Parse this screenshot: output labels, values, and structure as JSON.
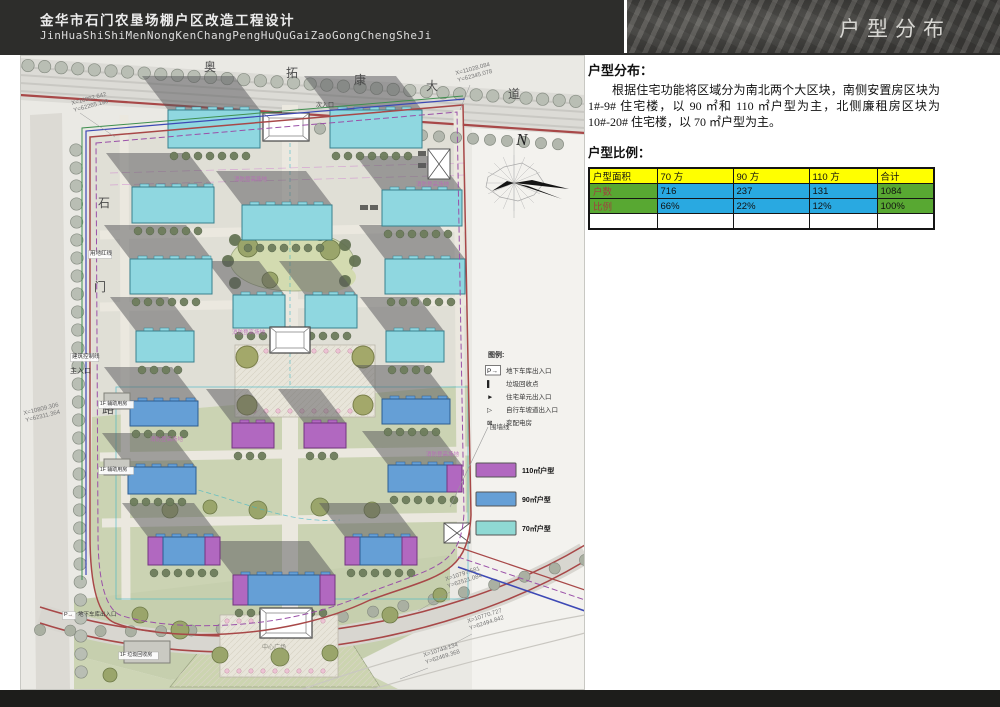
{
  "header": {
    "title_cn": "金华市石门农垦场棚户区改造工程设计",
    "title_en": "JinHuaShiShiMenNongKenChangPengHuQuGaiZaoGongChengSheJi",
    "section_title": "户型分布"
  },
  "panel": {
    "heading": "户型分布：",
    "paragraph": "根据住宅功能将区域分为南北两个大区块，南侧安置房区块为 1#-9# 住宅楼，以 90 ㎡和 110 ㎡户型为主，北侧廉租房区块为 10#-20# 住宅楼，以 70 ㎡户型为主。",
    "ratio_heading": "户型比例：",
    "table": {
      "columns": [
        "户型面积",
        "70 方",
        "90 方",
        "110 方",
        "合计"
      ],
      "col_widths": [
        68,
        76,
        76,
        68,
        57
      ],
      "rows": [
        {
          "label": "户数",
          "values": [
            "716",
            "237",
            "131",
            "1084"
          ]
        },
        {
          "label": "比例",
          "values": [
            "66%",
            "22%",
            "12%",
            "100%"
          ]
        }
      ],
      "colors": {
        "header_bg": "#ffff00",
        "label_bg": "#58a832",
        "label_text": "#a04040",
        "data_bg": "#29a9e1",
        "total_bg": "#58a832"
      }
    }
  },
  "map": {
    "north_label": "N",
    "colors": {
      "c": {
        "f": "#8fd7e0",
        "s": "#38808e"
      },
      "b": {
        "f": "#659fd6",
        "s": "#2c5d92"
      },
      "p": {
        "f": "#b168c0",
        "s": "#73357f"
      },
      "a": {
        "f": "#c9c9c2",
        "s": "#808078"
      },
      "shadow": "#55555a",
      "boundary_red": "#a84848",
      "boundary_purple": "#9a50a8",
      "boundary_blue": "#3d49b5",
      "boundary_green": "#3f8f4f"
    },
    "legend": {
      "title": "图例:",
      "items": [
        {
          "sym": "P→",
          "label": "地下车库出入口"
        },
        {
          "sym": "▌",
          "label": "垃圾回收点"
        },
        {
          "sym": "►",
          "label": "住宅单元出入口"
        },
        {
          "sym": "▷",
          "label": "自行车坡道出入口"
        },
        {
          "sym": "⊠",
          "label": "变配电房"
        }
      ]
    },
    "unit_types": [
      {
        "color": "#b168c0",
        "label": "110㎡户型"
      },
      {
        "color": "#659fd6",
        "label": "90㎡户型"
      },
      {
        "color": "#8fd9d4",
        "label": "70㎡户型"
      }
    ],
    "buildings": [
      {
        "x": 148,
        "y": 55,
        "w": 92,
        "h": 38,
        "t": "c"
      },
      {
        "x": 310,
        "y": 55,
        "w": 92,
        "h": 38,
        "t": "c"
      },
      {
        "x": 112,
        "y": 132,
        "w": 82,
        "h": 36,
        "t": "c"
      },
      {
        "x": 362,
        "y": 135,
        "w": 80,
        "h": 36,
        "t": "c"
      },
      {
        "x": 222,
        "y": 150,
        "w": 90,
        "h": 35,
        "t": "c"
      },
      {
        "x": 110,
        "y": 204,
        "w": 82,
        "h": 35,
        "t": "c"
      },
      {
        "x": 365,
        "y": 204,
        "w": 80,
        "h": 35,
        "t": "c"
      },
      {
        "x": 213,
        "y": 240,
        "w": 52,
        "h": 33,
        "t": "c",
        "n": "11"
      },
      {
        "x": 285,
        "y": 240,
        "w": 52,
        "h": 33,
        "t": "c",
        "n": "12"
      },
      {
        "x": 116,
        "y": 276,
        "w": 58,
        "h": 31,
        "t": "c",
        "n": "10"
      },
      {
        "x": 366,
        "y": 276,
        "w": 58,
        "h": 31,
        "t": "c",
        "n": "13"
      },
      {
        "x": 110,
        "y": 346,
        "w": 68,
        "h": 25,
        "t": "b"
      },
      {
        "x": 362,
        "y": 344,
        "w": 68,
        "h": 25,
        "t": "b"
      },
      {
        "x": 212,
        "y": 368,
        "w": 42,
        "h": 25,
        "t": "p"
      },
      {
        "x": 284,
        "y": 368,
        "w": 42,
        "h": 25,
        "t": "p"
      },
      {
        "x": 108,
        "y": 412,
        "w": 68,
        "h": 27,
        "t": "b"
      },
      {
        "x": 368,
        "y": 410,
        "w": 74,
        "h": 27,
        "t": "mbr"
      },
      {
        "x": 128,
        "y": 482,
        "w": 72,
        "h": 28,
        "t": "m"
      },
      {
        "x": 325,
        "y": 482,
        "w": 72,
        "h": 28,
        "t": "m"
      },
      {
        "x": 213,
        "y": 520,
        "w": 102,
        "h": 30,
        "t": "m"
      },
      {
        "x": 84,
        "y": 338,
        "w": 26,
        "h": 16,
        "t": "a"
      },
      {
        "x": 84,
        "y": 404,
        "w": 26,
        "h": 16,
        "t": "a"
      },
      {
        "x": 104,
        "y": 586,
        "w": 46,
        "h": 22,
        "t": "a"
      }
    ],
    "labels": [
      {
        "t": "奥",
        "x": 184,
        "y": 16,
        "s": 12,
        "c": "#4a4a4a"
      },
      {
        "t": "拓",
        "x": 266,
        "y": 22,
        "s": 12,
        "c": "#4a4a4a"
      },
      {
        "t": "康",
        "x": 334,
        "y": 29,
        "s": 12,
        "c": "#4a4a4a"
      },
      {
        "t": "大",
        "x": 406,
        "y": 35,
        "s": 12,
        "c": "#4a4a4a"
      },
      {
        "t": "道",
        "x": 488,
        "y": 43,
        "s": 12,
        "c": "#4a4a4a"
      },
      {
        "t": "石",
        "x": 78,
        "y": 152,
        "s": 12,
        "c": "#4a4a4a"
      },
      {
        "t": "门",
        "x": 74,
        "y": 236,
        "s": 12,
        "c": "#4a4a4a"
      },
      {
        "t": "路",
        "x": 82,
        "y": 358,
        "s": 12,
        "c": "#4a4a4a"
      },
      {
        "t": "N",
        "x": 496,
        "y": 90,
        "s": 17,
        "c": "#222222",
        "f": 1,
        "i": 1
      },
      {
        "t": "X=10962.642",
        "x": 52,
        "y": 50,
        "s": 6,
        "c": "#777777",
        "r": -15
      },
      {
        "t": "Y=62265.190",
        "x": 54,
        "y": 57,
        "s": 6,
        "c": "#777777",
        "r": -15
      },
      {
        "t": "X=11028.084",
        "x": 436,
        "y": 20,
        "s": 6,
        "c": "#777777",
        "r": -15
      },
      {
        "t": "Y=62345.078",
        "x": 438,
        "y": 27,
        "s": 6,
        "c": "#777777",
        "r": -15
      },
      {
        "t": "X=10809.306",
        "x": 4,
        "y": 360,
        "s": 6,
        "c": "#777777",
        "r": -14
      },
      {
        "t": "Y=62311.364",
        "x": 6,
        "y": 367,
        "s": 6,
        "c": "#777777",
        "r": -14
      },
      {
        "t": "X=10797.581",
        "x": 426,
        "y": 526,
        "s": 6,
        "c": "#777777",
        "r": -18
      },
      {
        "t": "Y=62521.084",
        "x": 428,
        "y": 533,
        "s": 6,
        "c": "#777777",
        "r": -18
      },
      {
        "t": "X=10770.727",
        "x": 448,
        "y": 568,
        "s": 6,
        "c": "#777777",
        "r": -18
      },
      {
        "t": "Y=62494.842",
        "x": 450,
        "y": 575,
        "s": 6,
        "c": "#777777",
        "r": -18
      },
      {
        "t": "X=10743.134",
        "x": 404,
        "y": 602,
        "s": 6,
        "c": "#777777",
        "r": -18
      },
      {
        "t": "Y=62469.368",
        "x": 406,
        "y": 609,
        "s": 6,
        "c": "#777777",
        "r": -18
      },
      {
        "t": "主入口",
        "x": 50,
        "y": 318,
        "s": 7,
        "c": "#333333"
      },
      {
        "t": "次入口",
        "x": 296,
        "y": 52,
        "s": 6,
        "c": "#444444"
      },
      {
        "t": "用地红线",
        "x": 70,
        "y": 200,
        "s": 5.5,
        "c": "#333333",
        "b": 1
      },
      {
        "t": "建筑控制线",
        "x": 52,
        "y": 303,
        "s": 5.5,
        "c": "#333333",
        "b": 1
      },
      {
        "t": "围墙线",
        "x": 470,
        "y": 374,
        "s": 6.5,
        "c": "#444444"
      },
      {
        "t": "P→",
        "x": 44,
        "y": 561,
        "s": 5.5,
        "c": "#333333",
        "b": 1
      },
      {
        "t": "地下车库出入口",
        "x": 58,
        "y": 561,
        "s": 5.5,
        "c": "#333333"
      },
      {
        "t": "1F 辅助用房",
        "x": 80,
        "y": 350,
        "s": 5,
        "c": "#333333",
        "b": 1
      },
      {
        "t": "1F 辅助用房",
        "x": 80,
        "y": 416,
        "s": 5,
        "c": "#333333",
        "b": 1
      },
      {
        "t": "1F 垃圾回收房",
        "x": 100,
        "y": 601,
        "s": 5,
        "c": "#333333",
        "b": 1
      },
      {
        "t": "消防登高场地",
        "x": 214,
        "y": 126,
        "s": 5.5,
        "c": "#bb66bb",
        "o": 0.85
      },
      {
        "t": "消防登高场地",
        "x": 396,
        "y": 131,
        "s": 5.5,
        "c": "#bb66bb",
        "o": 0.85
      },
      {
        "t": "消防登高场地",
        "x": 212,
        "y": 279,
        "s": 5.5,
        "c": "#bb66bb",
        "o": 0.85
      },
      {
        "t": "消防登高场地",
        "x": 130,
        "y": 386,
        "s": 5.5,
        "c": "#bb66bb",
        "o": 0.85
      },
      {
        "t": "消防登高场地",
        "x": 406,
        "y": 401,
        "s": 5.5,
        "c": "#bb66bb",
        "o": 0.85
      },
      {
        "t": "中心广场",
        "x": 242,
        "y": 594,
        "s": 6,
        "c": "#8a8a80"
      }
    ]
  }
}
